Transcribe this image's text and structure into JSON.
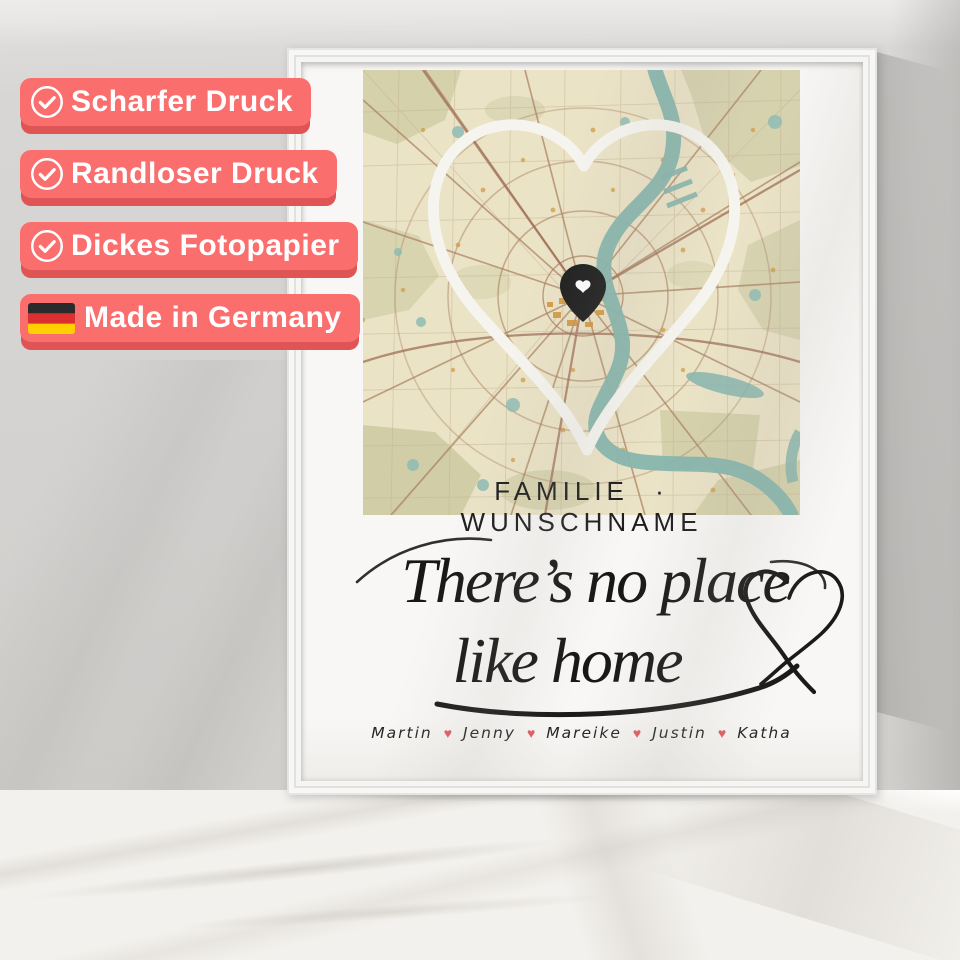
{
  "scene": {
    "wall_color": "#d5d3d1",
    "table_color": "#f3f1ed",
    "frame_color": "#f9f9f8"
  },
  "badges": {
    "style": {
      "background": "#fa6e6e",
      "edge": "#df5555",
      "text_color": "#ffffff"
    },
    "items": [
      {
        "icon": "check-circle",
        "label": "Scharfer Druck"
      },
      {
        "icon": "check-circle",
        "label": "Randloser Druck"
      },
      {
        "icon": "check-circle",
        "label": "Dickes Fotopapier"
      },
      {
        "icon": "german-flag",
        "label": "Made in Germany"
      }
    ]
  },
  "poster": {
    "subtitle": "FAMILIE · WUNSCHNAME",
    "quote": {
      "line1": "There’s no place",
      "line2": "like home"
    },
    "names": [
      "Martin",
      "Jenny",
      "Mareike",
      "Justin",
      "Katha"
    ],
    "name_separator": "♥",
    "name_heart_color": "#e4555a",
    "map": {
      "theme": "vintage",
      "pin": "heart-location-pin",
      "colors": {
        "base": "#ebe3c6",
        "water": "#87b5ad",
        "greenery": "#c6c59a",
        "roads": "#a8805f",
        "buildings": "#d2973e",
        "heart_outline": "#f6f4ef",
        "pin": "#1f1f1f"
      }
    }
  }
}
